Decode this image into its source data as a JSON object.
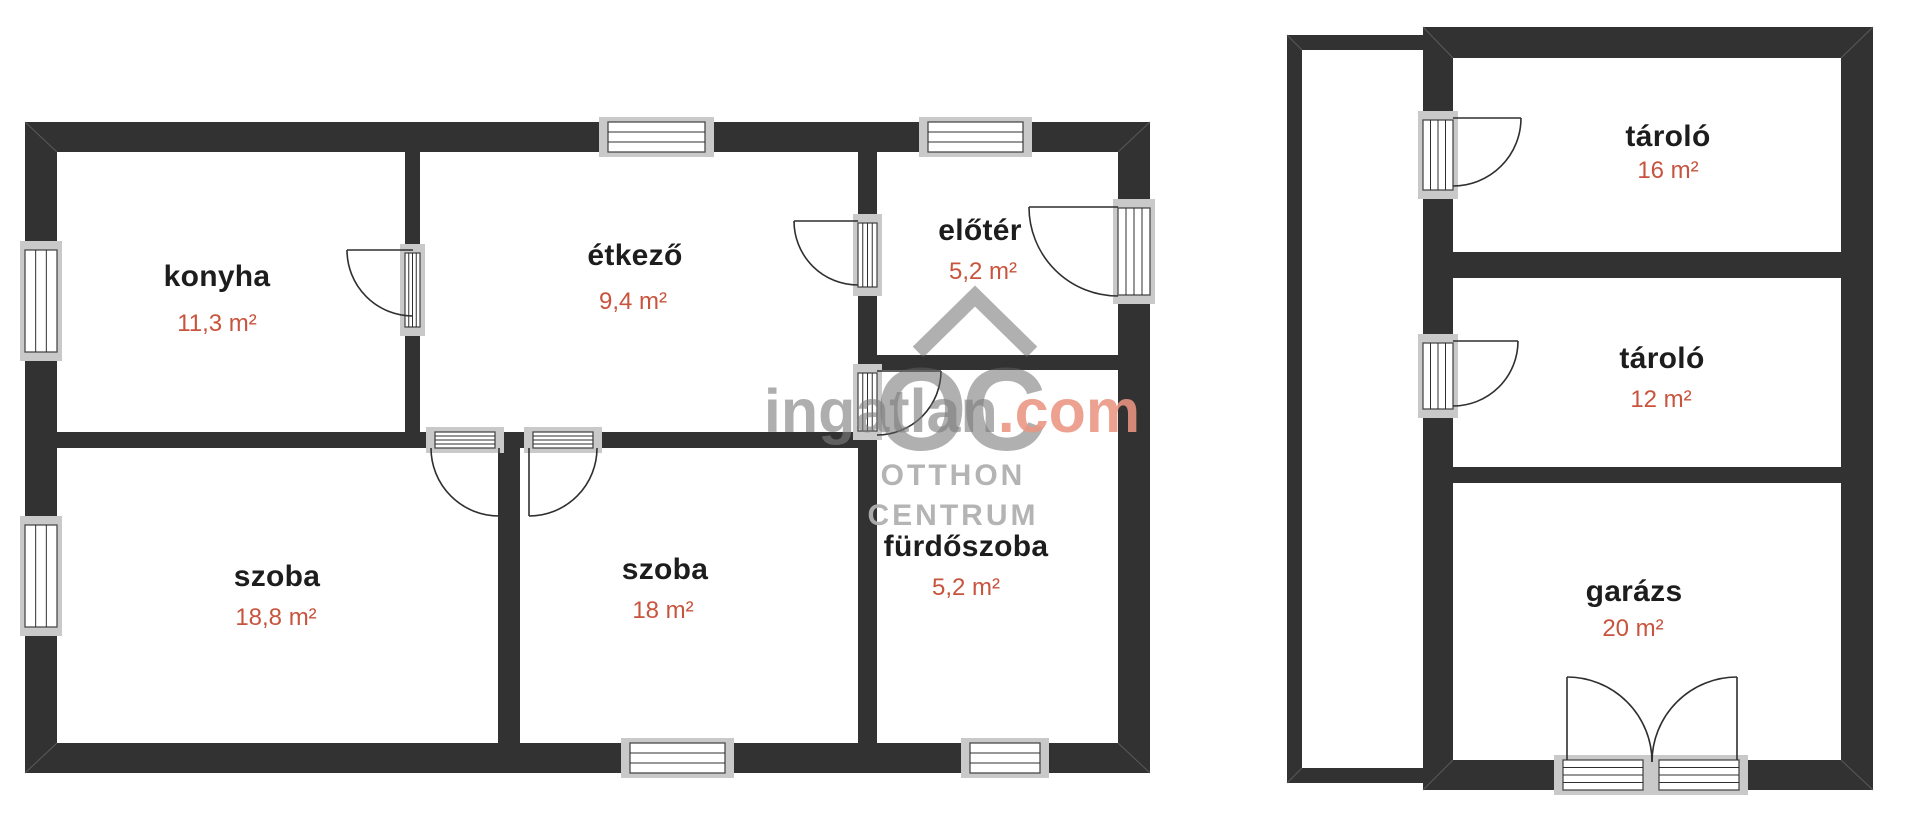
{
  "document": {
    "type": "floor-plan",
    "language": "hu"
  },
  "main_house": {
    "rooms": [
      {
        "name": "konyha",
        "area": "11,3 m²"
      },
      {
        "name": "étkező",
        "area": "9,4 m²"
      },
      {
        "name": "előtér",
        "area": "5,2 m²"
      },
      {
        "name": "szoba",
        "area": "18,8 m²"
      },
      {
        "name": "szoba",
        "area": "18 m²"
      },
      {
        "name": "fürdőszoba",
        "area": "5,2 m²"
      }
    ]
  },
  "outbuilding": {
    "rooms": [
      {
        "name": "tároló",
        "area": "16 m²"
      },
      {
        "name": "tároló",
        "area": "12 m²"
      },
      {
        "name": "garázs",
        "area": "20 m²"
      }
    ]
  },
  "watermark": {
    "brand_gray": "ingatlan",
    "brand_accent": ".com",
    "logo_text": "OC",
    "logo_line1": "OTTHON",
    "logo_line2": "CENTRUM"
  },
  "colors": {
    "wall": "#323232",
    "room_name": "#1d1d1d",
    "room_area": "#c8543e",
    "watermark_gray": "#9b9b9b",
    "watermark_accent": "#ea9481",
    "frame_gray": "#c9c9c9"
  }
}
